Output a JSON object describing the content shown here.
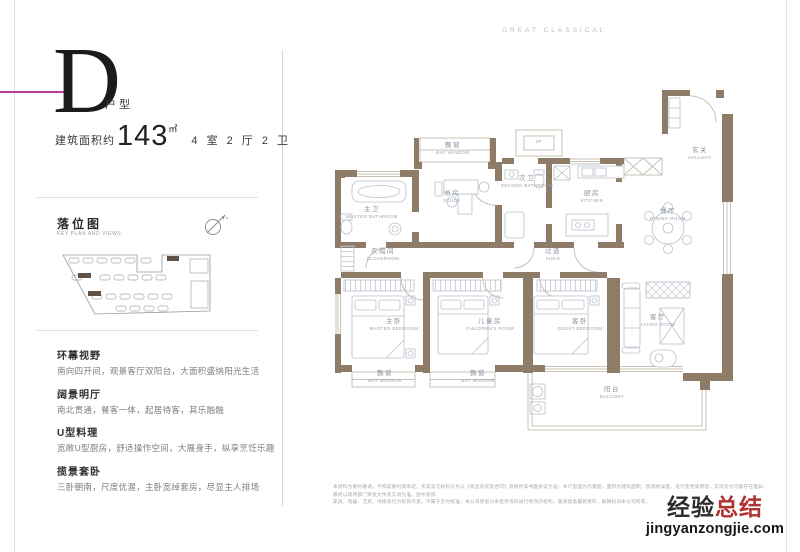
{
  "brand": "GREAT CLASSICAL",
  "unit": {
    "letter": "D",
    "type_suffix": "户型",
    "area_label": "建筑面积约",
    "area_value": "143",
    "area_unit": "㎡",
    "rooms_layout": "4 室 2 厅 2 卫"
  },
  "key_plan": {
    "title": "落位图",
    "subtitle": "KEY PLAN AND VIEWS",
    "compass_icon": "north-compass"
  },
  "features": [
    {
      "title": "环幕视野",
      "desc": "南向四开间，观景客厅双阳台，大面积盛纳阳光生活"
    },
    {
      "title": "阔景明厅",
      "desc": "南北贯通，餐客一体，起居待客，其乐融融"
    },
    {
      "title": "U型料理",
      "desc": "宽敞U型厨房，舒适操作空间，大展身手，纵享烹饪乐趣"
    },
    {
      "title": "揽景套卧",
      "desc": "三卧朝南，尺度优渥，主卧宽绰套房，尽显主人排场"
    }
  ],
  "floor_plan": {
    "rooms": [
      {
        "cn": "飘窗",
        "en": "BAY WINDOW"
      },
      {
        "cn": "书房",
        "en": "STUDY"
      },
      {
        "cn": "主卫",
        "en": "MASTER BATHROOM"
      },
      {
        "cn": "次卫",
        "en": "SECOND BATHROOM"
      },
      {
        "cn": "厨房",
        "en": "KITCHEN"
      },
      {
        "cn": "餐厅",
        "en": "DINING ROOM"
      },
      {
        "cn": "玄关",
        "en": "HALLWAY"
      },
      {
        "cn": "衣帽间",
        "en": "CLOAKROOM"
      },
      {
        "cn": "过道",
        "en": "AISLE"
      },
      {
        "cn": "主卧",
        "en": "MASTER BEDROOM"
      },
      {
        "cn": "儿童房",
        "en": "CHILDREN'S ROOM"
      },
      {
        "cn": "客卧",
        "en": "GUEST BEDROOM"
      },
      {
        "cn": "客厅",
        "en": "LIVING ROOM"
      },
      {
        "cn": "飘窗",
        "en": "BAY WINDOW"
      },
      {
        "cn": "飘窗",
        "en": "BAY WINDOW"
      },
      {
        "cn": "阳台",
        "en": "BALCONY"
      },
      {
        "cn": "2F",
        "en": ""
      }
    ]
  },
  "disclaimer": {
    "line1": "本资料为要约邀请，不构成要约或承诺，买卖双方权利义务以《商品房买卖合同》及附件等书面协议为准；本户型图为示意图，面积为建筑面积，因测绘误差、设计变更等原因，实际交付可能存在差异，最终以政府部门审批文件及实测为准，图中装修、",
    "line2": "家具、电器、洁具、绿植等仅为装饰示意，不属于交付标准；本公司保留对本宣传资料进行修改的权利，敬请留意最新资料，解释权归本公司所有。"
  },
  "watermark": {
    "part_black": "经验",
    "part_red": "总结",
    "domain": "jingyanzongjie.com"
  },
  "colors": {
    "accent_magenta": "#b93d9e",
    "wall_brown": "#8e7c69",
    "watermark_red": "#b23230"
  }
}
